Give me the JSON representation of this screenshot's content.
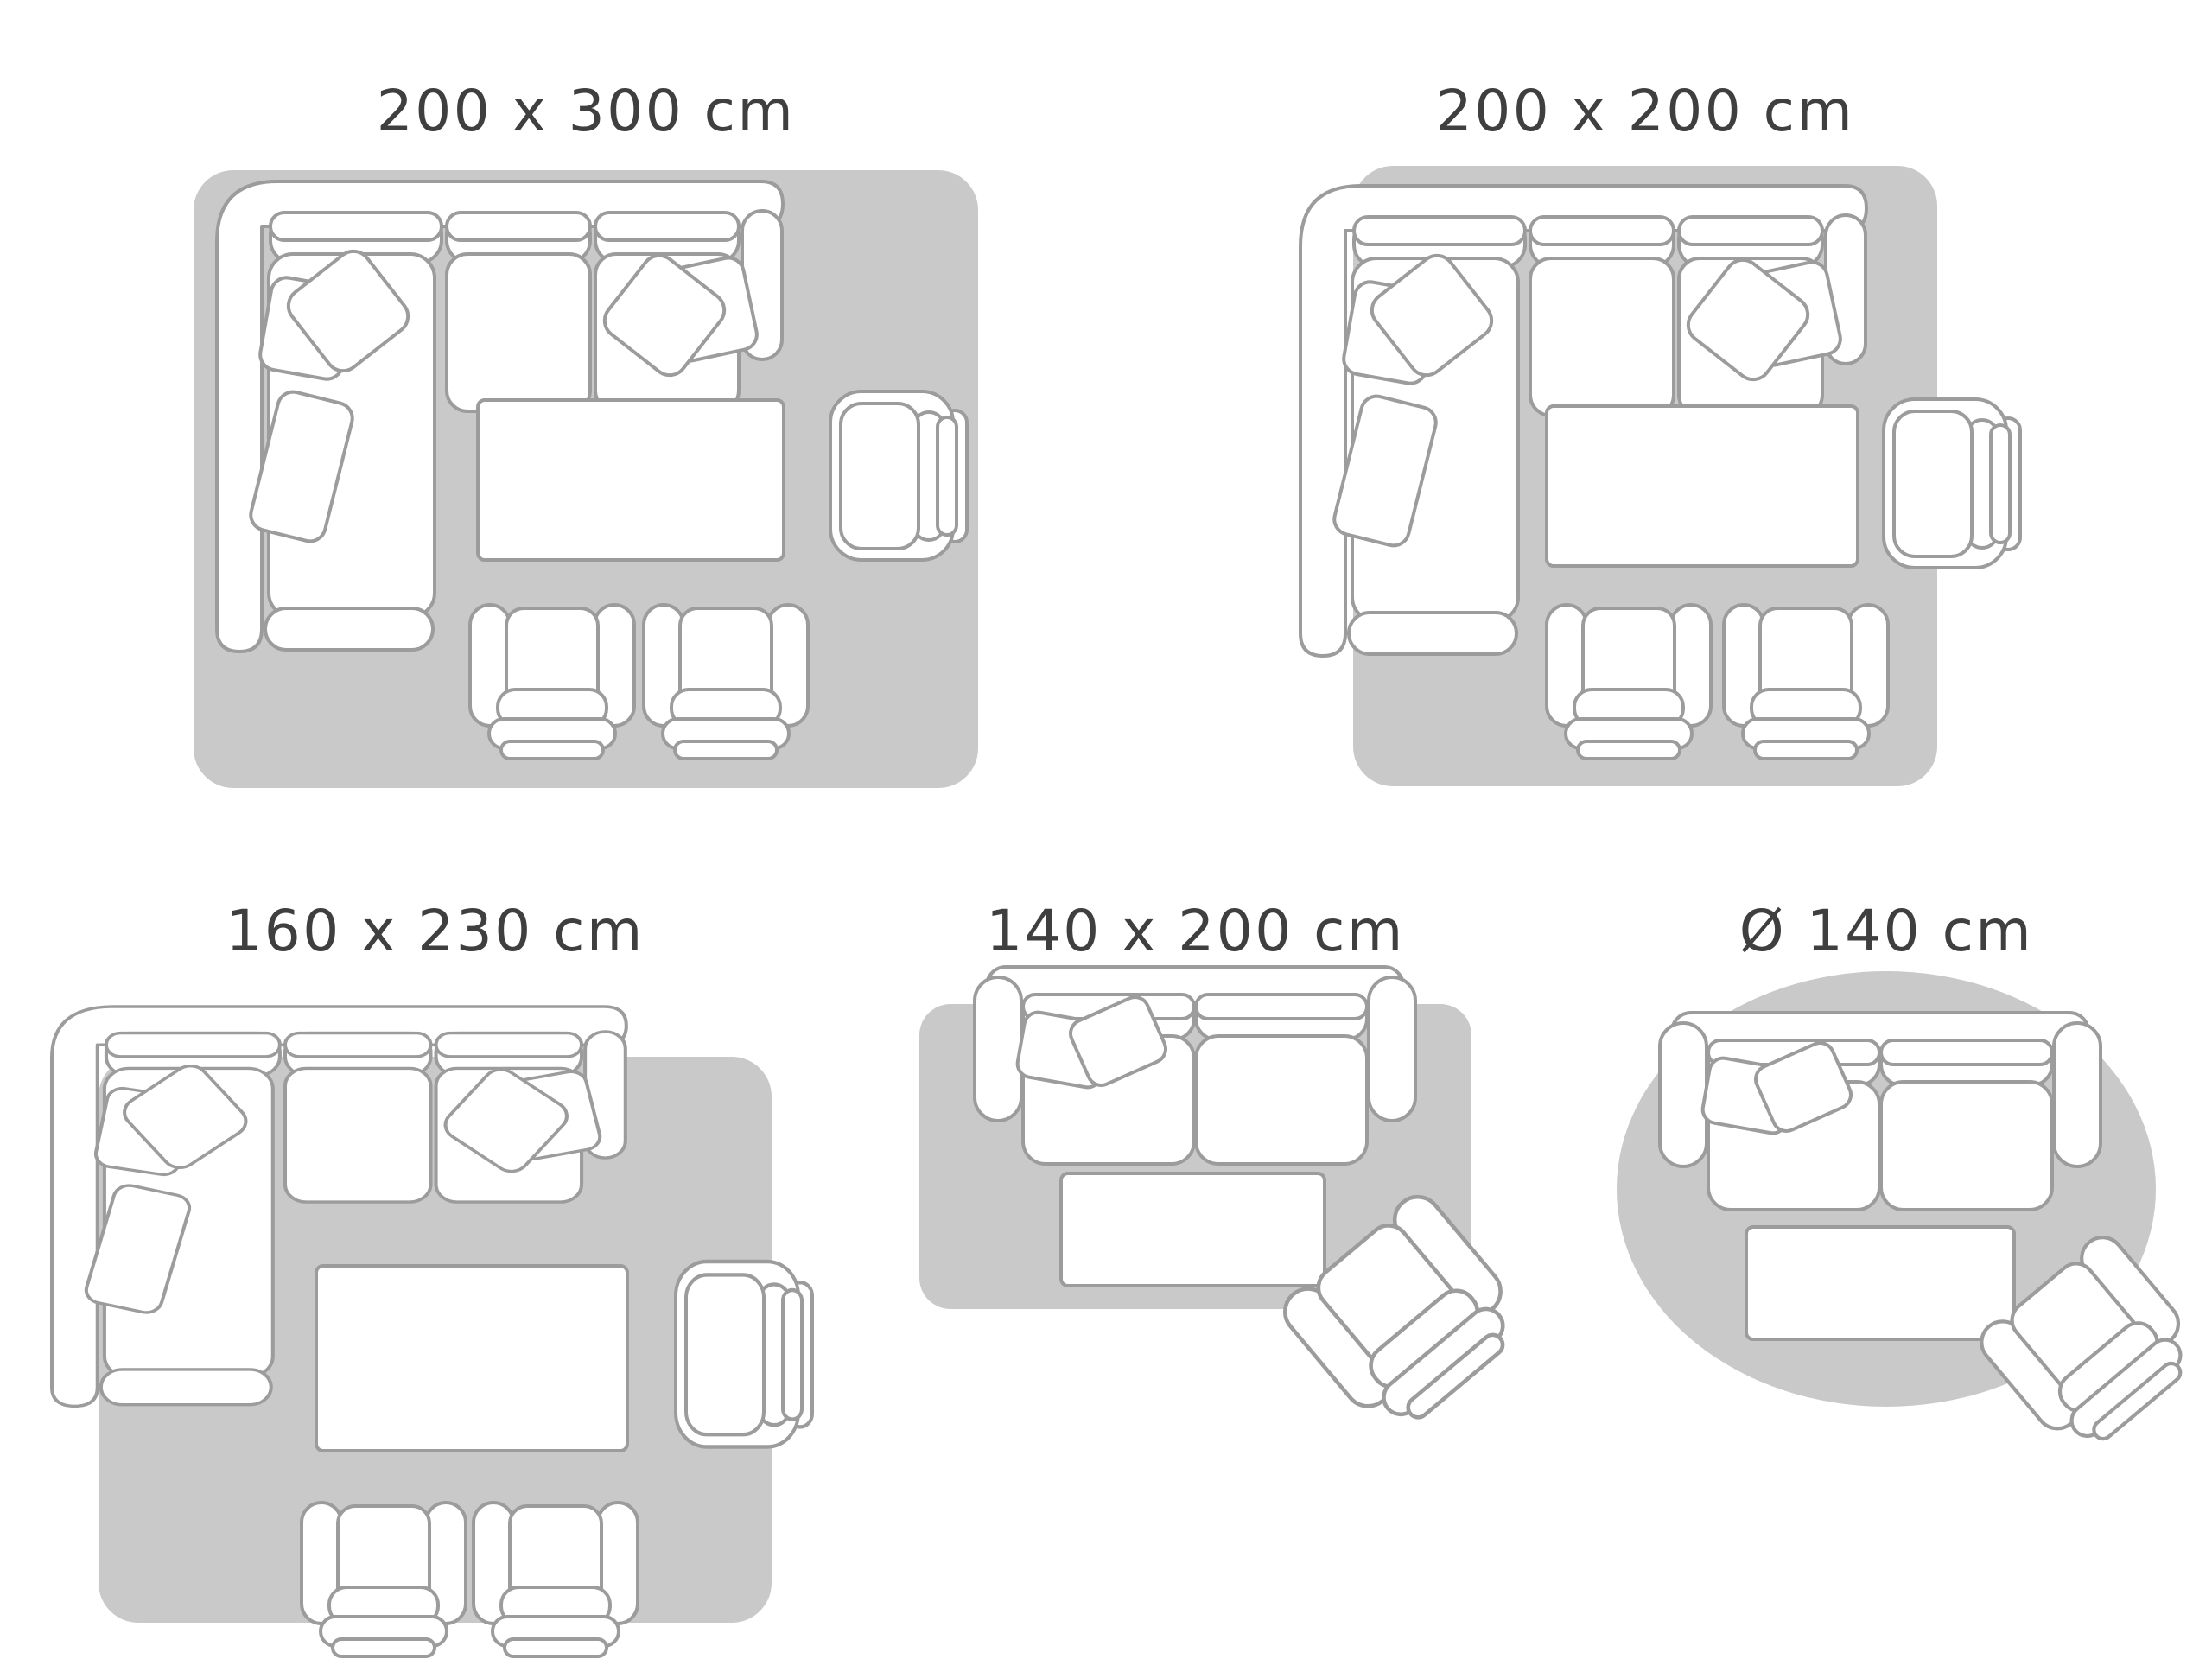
{
  "colors": {
    "background": "#ffffff",
    "rug_fill": "#c9c9c9",
    "furniture_fill": "#ffffff",
    "furniture_outline": "#9c9c9c",
    "title_text": "#3f3f3f"
  },
  "diagrams": [
    {
      "id": "200x300",
      "label": "200 x 300 cm",
      "rug_shape": "rectangle",
      "furniture": [
        "corner-sofa",
        "coffee-table",
        "armchair",
        "lounge-chair",
        "lounge-chair"
      ]
    },
    {
      "id": "200x200",
      "label": "200 x 200 cm",
      "rug_shape": "rectangle",
      "furniture": [
        "corner-sofa",
        "coffee-table",
        "armchair",
        "lounge-chair",
        "lounge-chair"
      ]
    },
    {
      "id": "160x230",
      "label": "160 x 230 cm",
      "rug_shape": "rectangle",
      "furniture": [
        "corner-sofa",
        "coffee-table",
        "armchair",
        "lounge-chair",
        "lounge-chair"
      ]
    },
    {
      "id": "140x200",
      "label": "140 x 200 cm",
      "rug_shape": "rectangle",
      "furniture": [
        "two-seat-sofa",
        "coffee-table",
        "angled-armchair"
      ]
    },
    {
      "id": "d140",
      "label": "Ø 140 cm",
      "rug_shape": "circle",
      "furniture": [
        "two-seat-sofa",
        "coffee-table",
        "angled-armchair"
      ]
    }
  ]
}
